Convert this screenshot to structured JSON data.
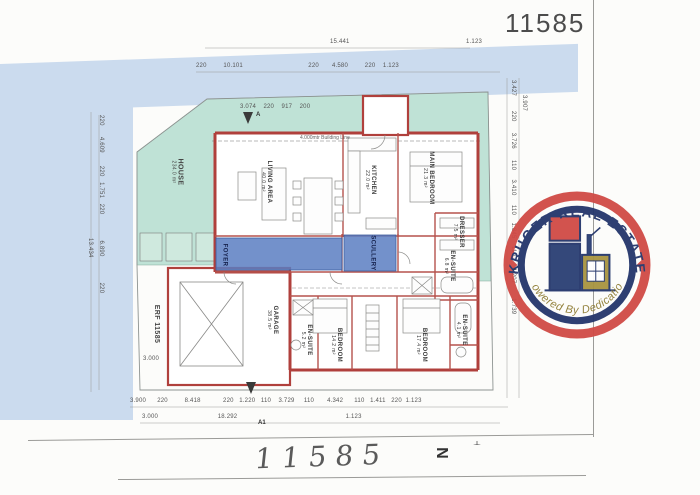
{
  "page": {
    "doc_number_top": "11585",
    "doc_number_handwritten": "11585"
  },
  "logo": {
    "arc_top": "KRUGER REAL ESTATE",
    "arc_bottom": "Powered By Dedication",
    "colors": {
      "ring_red": "#d04a45",
      "ring_navy": "#23356b",
      "gold": "#a89440"
    }
  },
  "plan": {
    "erf_label": "ERF 11585",
    "house_label": {
      "name": "HOUSE",
      "area": "234.0 m²"
    },
    "rooms": {
      "living": {
        "label": "LIVING AREA",
        "area": "40.0 m²"
      },
      "kitchen": {
        "label": "KITCHEN",
        "area": "22.0 m²"
      },
      "main_bedroom": {
        "label": "MAIN BEDROOM",
        "area": "21.3 m²"
      },
      "dresser": {
        "label": "DRESSER",
        "area": "7.5 m²"
      },
      "ensuite_main": {
        "label": "EN-SUITE",
        "area": "6.8 m²"
      },
      "foyer": {
        "label": "FOYER"
      },
      "scullery": {
        "label": "SCULLERY"
      },
      "garage": {
        "label": "GARAGE",
        "area": "38.5 m²"
      },
      "bedroom_left": {
        "label": "BEDROOM",
        "area": "14.2 m²"
      },
      "bedroom_right": {
        "label": "BEDROOM",
        "area": "17.4 m²"
      },
      "ensuite_left": {
        "label": "EN-SUITE",
        "area": "5.2 m²"
      },
      "ensuite_right": {
        "label": "EN-SUITE",
        "area": "4.1 m²"
      }
    },
    "annotations": {
      "building_line": "4.000mtr Building Line",
      "section_a": "A",
      "section_a1": "A1",
      "north": "N"
    },
    "dimensions": {
      "top_overall": "15.441",
      "top_right": "1.123",
      "top_row2": "220         10.101                                   220       4.580         220    1.123",
      "upper_inner": "3.074    220    917    200",
      "bottom_row1": "3.900      220         8.418            220   1.220   110    3.729     110       4.342      110   1.411   220  1.123",
      "bottom_row2": "3.000                                18.292                                                          1.123",
      "left_col": "220      4.609       220   1.751   220              6.890              220",
      "left_overall": "13.434",
      "garage_width": "3.000",
      "right_col": "3.427        220      3.726      110     3.410     110    1.845    110      4.207        1.739",
      "right_top": "3.907"
    },
    "colors": {
      "yard": "#bfe2d6",
      "highlight": "#5b7ec2",
      "wall": "#b0403c",
      "band": "#cbdbee"
    }
  }
}
